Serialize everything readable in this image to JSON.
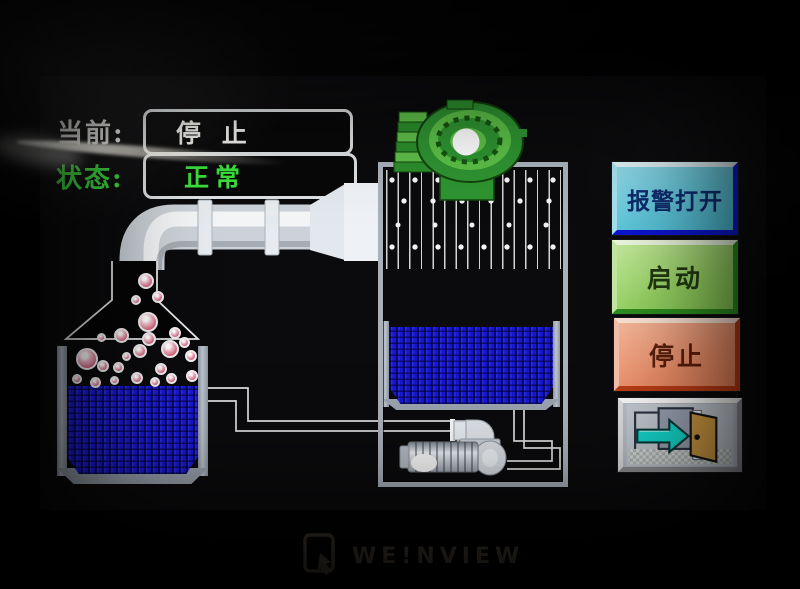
{
  "hmi": {
    "current": {
      "label": "当前:",
      "value": "停 止"
    },
    "status": {
      "label": "状态:",
      "value": "正常"
    }
  },
  "buttons": {
    "alarm_label": "报警打开",
    "start_label": "启动",
    "stop_label": "停止"
  },
  "brand": {
    "logo_text": "WE!NVIEW"
  },
  "icons": {
    "fan": "blower-fan",
    "pump": "centrifugal-pump",
    "exit": "exit-door-arrow"
  },
  "colors": {
    "status_green": "#3ce03c",
    "text_white": "#f2f1ee",
    "liquid_blue": "#1717d2",
    "fan_green": "#2f9431",
    "tank_silver": "#a9b1bb",
    "alarm_button": "#5fc9de",
    "alarm_border_blue": "#0a14d2",
    "start_button": "#97d463",
    "stop_button": "#ee906a",
    "exit_arrow_cyan": "#14d8cc",
    "door_tan": "#cf9a42"
  }
}
